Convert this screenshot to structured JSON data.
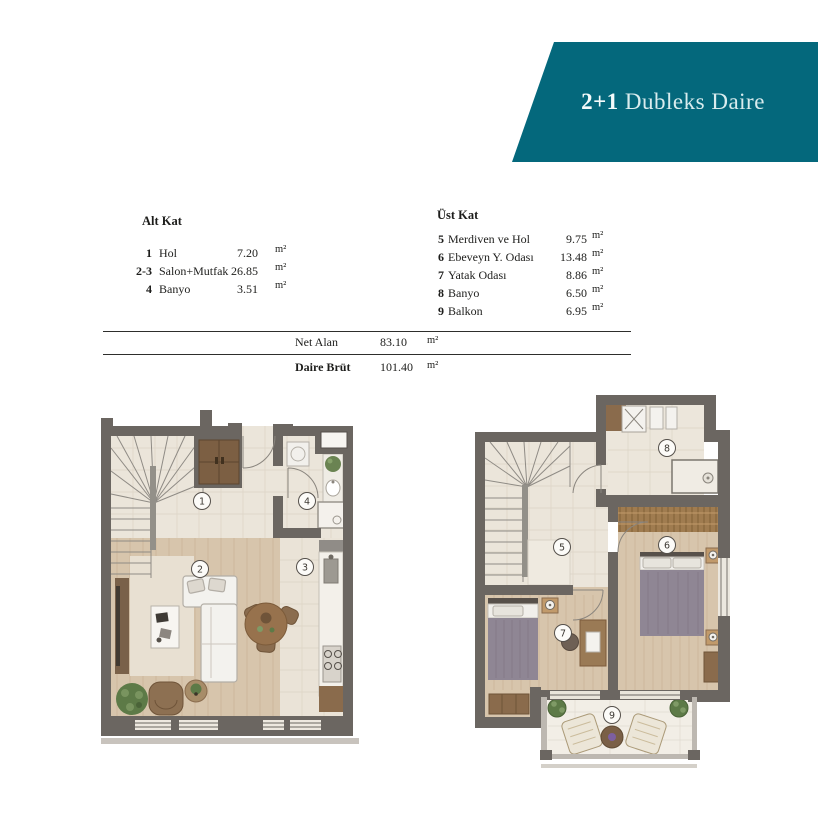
{
  "header": {
    "title_bold": "2+1",
    "title_rest": " Dubleks Daire"
  },
  "tables": {
    "alt": {
      "heading": "Alt Kat",
      "rows": [
        {
          "no": "1",
          "name": "Hol",
          "value": "7.20",
          "unit": "m²"
        },
        {
          "no": "2-3",
          "name": "Salon+Mutfak",
          "value": "26.85",
          "unit": "m²"
        },
        {
          "no": "4",
          "name": "Banyo",
          "value": "3.51",
          "unit": "m²"
        }
      ]
    },
    "ust": {
      "heading": "Üst Kat",
      "rows": [
        {
          "no": "5",
          "name": "Merdiven ve Hol",
          "value": "9.75",
          "unit": "m²"
        },
        {
          "no": "6",
          "name": "Ebeveyn Y. Odası",
          "value": "13.48",
          "unit": "m²"
        },
        {
          "no": "7",
          "name": "Yatak Odası",
          "value": "8.86",
          "unit": "m²"
        },
        {
          "no": "8",
          "name": "Banyo",
          "value": "6.50",
          "unit": "m²"
        },
        {
          "no": "9",
          "name": "Balkon",
          "value": "6.95",
          "unit": "m²"
        }
      ]
    }
  },
  "summary": {
    "net": {
      "label": "Net Alan",
      "value": "83.10",
      "unit": "m²"
    },
    "brut": {
      "label": "Daire Brüt",
      "value": "101.40",
      "unit": "m²"
    }
  },
  "plans": {
    "alt": {
      "room_labels": [
        "1",
        "2",
        "3",
        "4"
      ]
    },
    "ust": {
      "room_labels": [
        "5",
        "6",
        "7",
        "8",
        "9"
      ]
    }
  },
  "colors": {
    "accent_teal": "#04687c",
    "wall_gray": "#6b6661",
    "floor_cream": "#ebe5da",
    "floor_wood": "#d7c5ac",
    "furniture_brown": "#8a6b4c",
    "plant_green": "#5d7a47",
    "blanket_gray": "#8f8694",
    "rail_gray": "#bdb8b1"
  }
}
